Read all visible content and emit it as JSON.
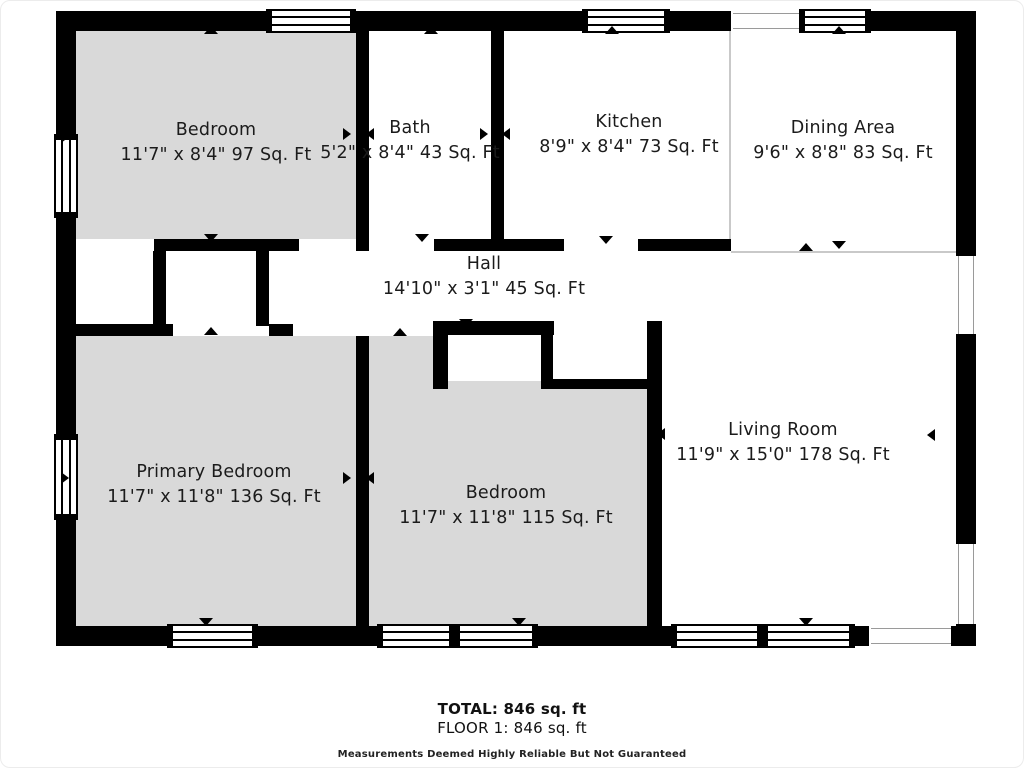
{
  "palette": {
    "wall": "#000000",
    "room_gray": "#d9d9d9",
    "room_white": "#ffffff",
    "boundary_line": "#c9c9c9",
    "text": "#1b1b1b"
  },
  "footer": {
    "total": "TOTAL: 846 sq. ft",
    "floor": "FLOOR 1: 846 sq. ft",
    "disclaimer": "Measurements Deemed Highly Reliable But Not Guaranteed"
  },
  "floorplan": {
    "rooms": [
      {
        "id": "bedroom-top",
        "name": "Bedroom",
        "dims": "11'7\" x 8'4\" 97 Sq. Ft",
        "fill": "gray",
        "rect": [
          75,
          30,
          280,
          208
        ],
        "label": [
          215,
          142
        ]
      },
      {
        "id": "bath",
        "name": "Bath",
        "dims": "5'2\" x 8'4\" 43 Sq. Ft",
        "fill": "white",
        "rect": [
          368,
          30,
          122,
          208
        ],
        "label": [
          409,
          140
        ]
      },
      {
        "id": "kitchen",
        "name": "Kitchen",
        "dims": "8'9\" x 8'4\" 73 Sq. Ft",
        "fill": "white",
        "rect": [
          503,
          30,
          225,
          208
        ],
        "label": [
          628,
          134
        ]
      },
      {
        "id": "dining-area",
        "name": "Dining Area",
        "dims": "9'6\" x 8'8\" 83 Sq. Ft",
        "fill": "white",
        "rect": [
          730,
          30,
          225,
          220
        ],
        "label": [
          842,
          140
        ]
      },
      {
        "id": "hall",
        "name": "Hall",
        "dims": "14'10\" x 3'1\" 45 Sq. Ft",
        "fill": "white",
        "rect": [
          292,
          250,
          354,
          70
        ],
        "label": [
          483,
          276
        ]
      },
      {
        "id": "primary-bedroom",
        "name": "Primary Bedroom",
        "dims": "11'7\" x 11'8\" 136 Sq. Ft",
        "fill": "gray",
        "rect": [
          75,
          335,
          280,
          290
        ],
        "label": [
          213,
          484
        ]
      },
      {
        "id": "bedroom-middle",
        "name": "Bedroom",
        "dims": "11'7\" x 11'8\" 115 Sq. Ft",
        "fill": "gray",
        "rect": [
          368,
          335,
          278,
          290
        ],
        "label": [
          505,
          505
        ]
      },
      {
        "id": "living-room",
        "name": "Living Room",
        "dims": "11'9\" x 15'0\" 178 Sq. Ft",
        "fill": "white",
        "rect": [
          660,
          252,
          295,
          373
        ],
        "label": [
          782,
          442
        ]
      }
    ],
    "white_patches": [
      [
        447,
        334,
        93,
        46
      ],
      [
        552,
        334,
        94,
        46
      ]
    ],
    "thin_lines": [
      [
        728,
        30,
        2,
        208
      ],
      [
        730,
        250,
        227,
        2
      ]
    ],
    "walls": [
      [
        55,
        10,
        212,
        20
      ],
      [
        353,
        10,
        230,
        20
      ],
      [
        667,
        10,
        63,
        20
      ],
      [
        868,
        10,
        107,
        20
      ],
      [
        55,
        10,
        20,
        125
      ],
      [
        55,
        215,
        20,
        220
      ],
      [
        55,
        517,
        20,
        128
      ],
      [
        955,
        10,
        20,
        245
      ],
      [
        955,
        333,
        20,
        210
      ],
      [
        955,
        623,
        20,
        22
      ],
      [
        55,
        625,
        113,
        20
      ],
      [
        255,
        625,
        123,
        20
      ],
      [
        535,
        625,
        137,
        20
      ],
      [
        852,
        625,
        16,
        20
      ],
      [
        950,
        625,
        25,
        20
      ],
      [
        355,
        30,
        13,
        220
      ],
      [
        490,
        30,
        13,
        220
      ],
      [
        55,
        238,
        20,
        12
      ],
      [
        153,
        238,
        145,
        12
      ],
      [
        433,
        238,
        130,
        12
      ],
      [
        637,
        238,
        93,
        12
      ],
      [
        152,
        250,
        13,
        85
      ],
      [
        255,
        250,
        13,
        75
      ],
      [
        268,
        323,
        24,
        12
      ],
      [
        75,
        323,
        97,
        12
      ],
      [
        432,
        320,
        121,
        14
      ],
      [
        432,
        334,
        15,
        54
      ],
      [
        540,
        334,
        12,
        54
      ],
      [
        432,
        378,
        15,
        10
      ],
      [
        540,
        378,
        117,
        10
      ],
      [
        646,
        320,
        15,
        305
      ],
      [
        355,
        335,
        13,
        290
      ]
    ],
    "windows": [
      {
        "rect": [
          265,
          8,
          90,
          24
        ],
        "o": "h"
      },
      {
        "rect": [
          581,
          8,
          88,
          24
        ],
        "o": "h"
      },
      {
        "rect": [
          798,
          8,
          72,
          24
        ],
        "o": "h"
      },
      {
        "rect": [
          53,
          133,
          24,
          84
        ],
        "o": "v"
      },
      {
        "rect": [
          53,
          433,
          24,
          86
        ],
        "o": "v"
      },
      {
        "rect": [
          166,
          623,
          91,
          24
        ],
        "o": "h"
      },
      {
        "rect": [
          376,
          623,
          78,
          24
        ],
        "o": "h"
      },
      {
        "rect": [
          453,
          623,
          84,
          24
        ],
        "o": "h"
      },
      {
        "rect": [
          670,
          623,
          92,
          24
        ],
        "o": "h"
      },
      {
        "rect": [
          761,
          623,
          93,
          24
        ],
        "o": "h"
      }
    ],
    "openings": [
      {
        "rect": [
          732,
          12,
          66,
          16
        ],
        "o": "h"
      },
      {
        "rect": [
          957,
          255,
          16,
          78
        ],
        "o": "v"
      },
      {
        "rect": [
          957,
          543,
          16,
          80
        ],
        "o": "v"
      },
      {
        "rect": [
          870,
          627,
          80,
          16
        ],
        "o": "h"
      }
    ],
    "markers": [
      {
        "x": 210,
        "y": 29,
        "d": "up"
      },
      {
        "x": 430,
        "y": 29,
        "d": "up"
      },
      {
        "x": 611,
        "y": 29,
        "d": "up"
      },
      {
        "x": 838,
        "y": 29,
        "d": "up"
      },
      {
        "x": 210,
        "y": 237,
        "d": "down"
      },
      {
        "x": 421,
        "y": 237,
        "d": "down"
      },
      {
        "x": 605,
        "y": 239,
        "d": "down"
      },
      {
        "x": 805,
        "y": 246,
        "d": "up"
      },
      {
        "x": 838,
        "y": 244,
        "d": "down"
      },
      {
        "x": 465,
        "y": 322,
        "d": "down"
      },
      {
        "x": 210,
        "y": 330,
        "d": "up"
      },
      {
        "x": 399,
        "y": 331,
        "d": "up"
      },
      {
        "x": 205,
        "y": 621,
        "d": "down"
      },
      {
        "x": 518,
        "y": 621,
        "d": "down"
      },
      {
        "x": 805,
        "y": 621,
        "d": "down"
      },
      {
        "x": 67,
        "y": 136,
        "d": "right"
      },
      {
        "x": 67,
        "y": 477,
        "d": "right"
      },
      {
        "x": 349,
        "y": 133,
        "d": "right"
      },
      {
        "x": 372,
        "y": 133,
        "d": "left"
      },
      {
        "x": 486,
        "y": 133,
        "d": "right"
      },
      {
        "x": 508,
        "y": 133,
        "d": "left"
      },
      {
        "x": 349,
        "y": 477,
        "d": "right"
      },
      {
        "x": 372,
        "y": 477,
        "d": "left"
      },
      {
        "x": 663,
        "y": 433,
        "d": "left"
      },
      {
        "x": 933,
        "y": 434,
        "d": "left"
      }
    ]
  }
}
